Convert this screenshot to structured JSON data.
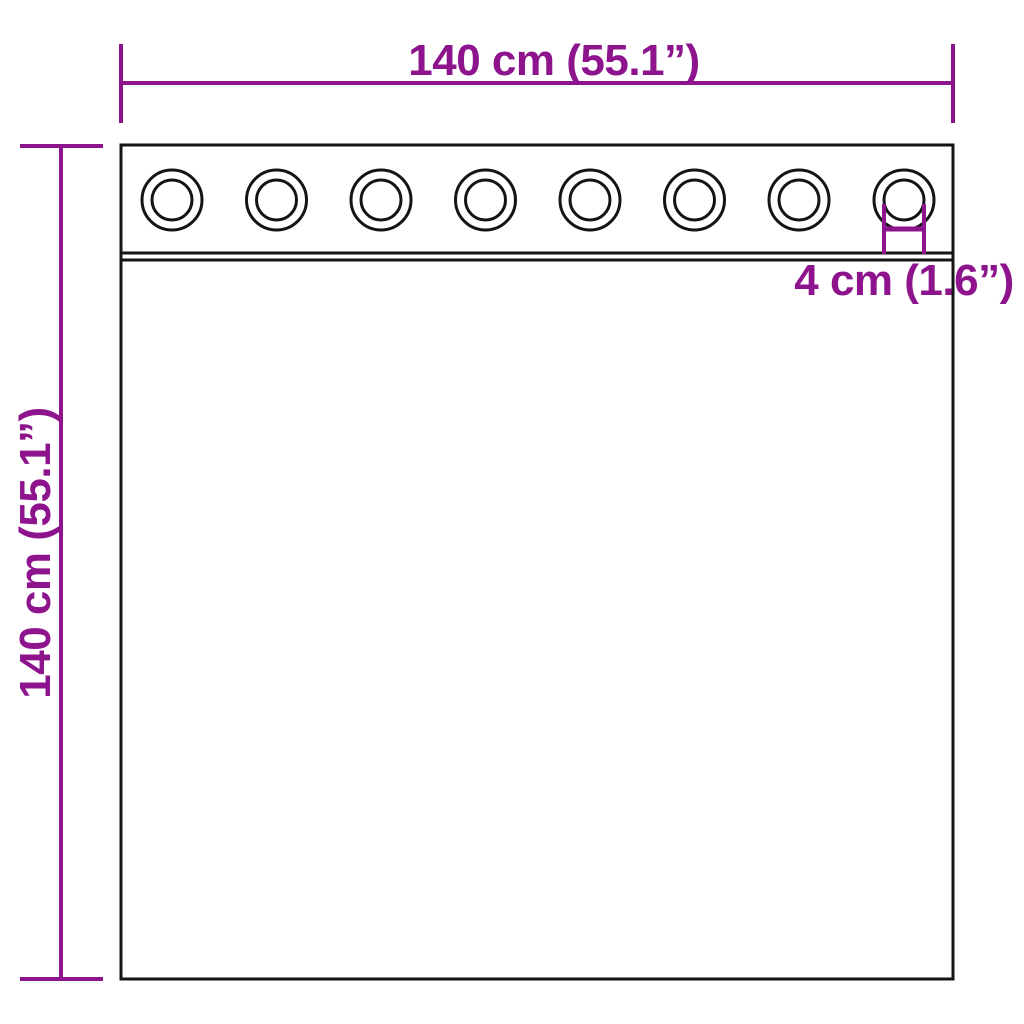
{
  "figure": {
    "labels": {
      "width": "140 cm (55.1”)",
      "height": "140 cm (55.1”)",
      "grommet": "4 cm (1.6”)"
    },
    "grommet_count": 8
  },
  "colors": {
    "dimension": "#8E148E",
    "outline": "#141414",
    "background": "#FFFFFF"
  }
}
